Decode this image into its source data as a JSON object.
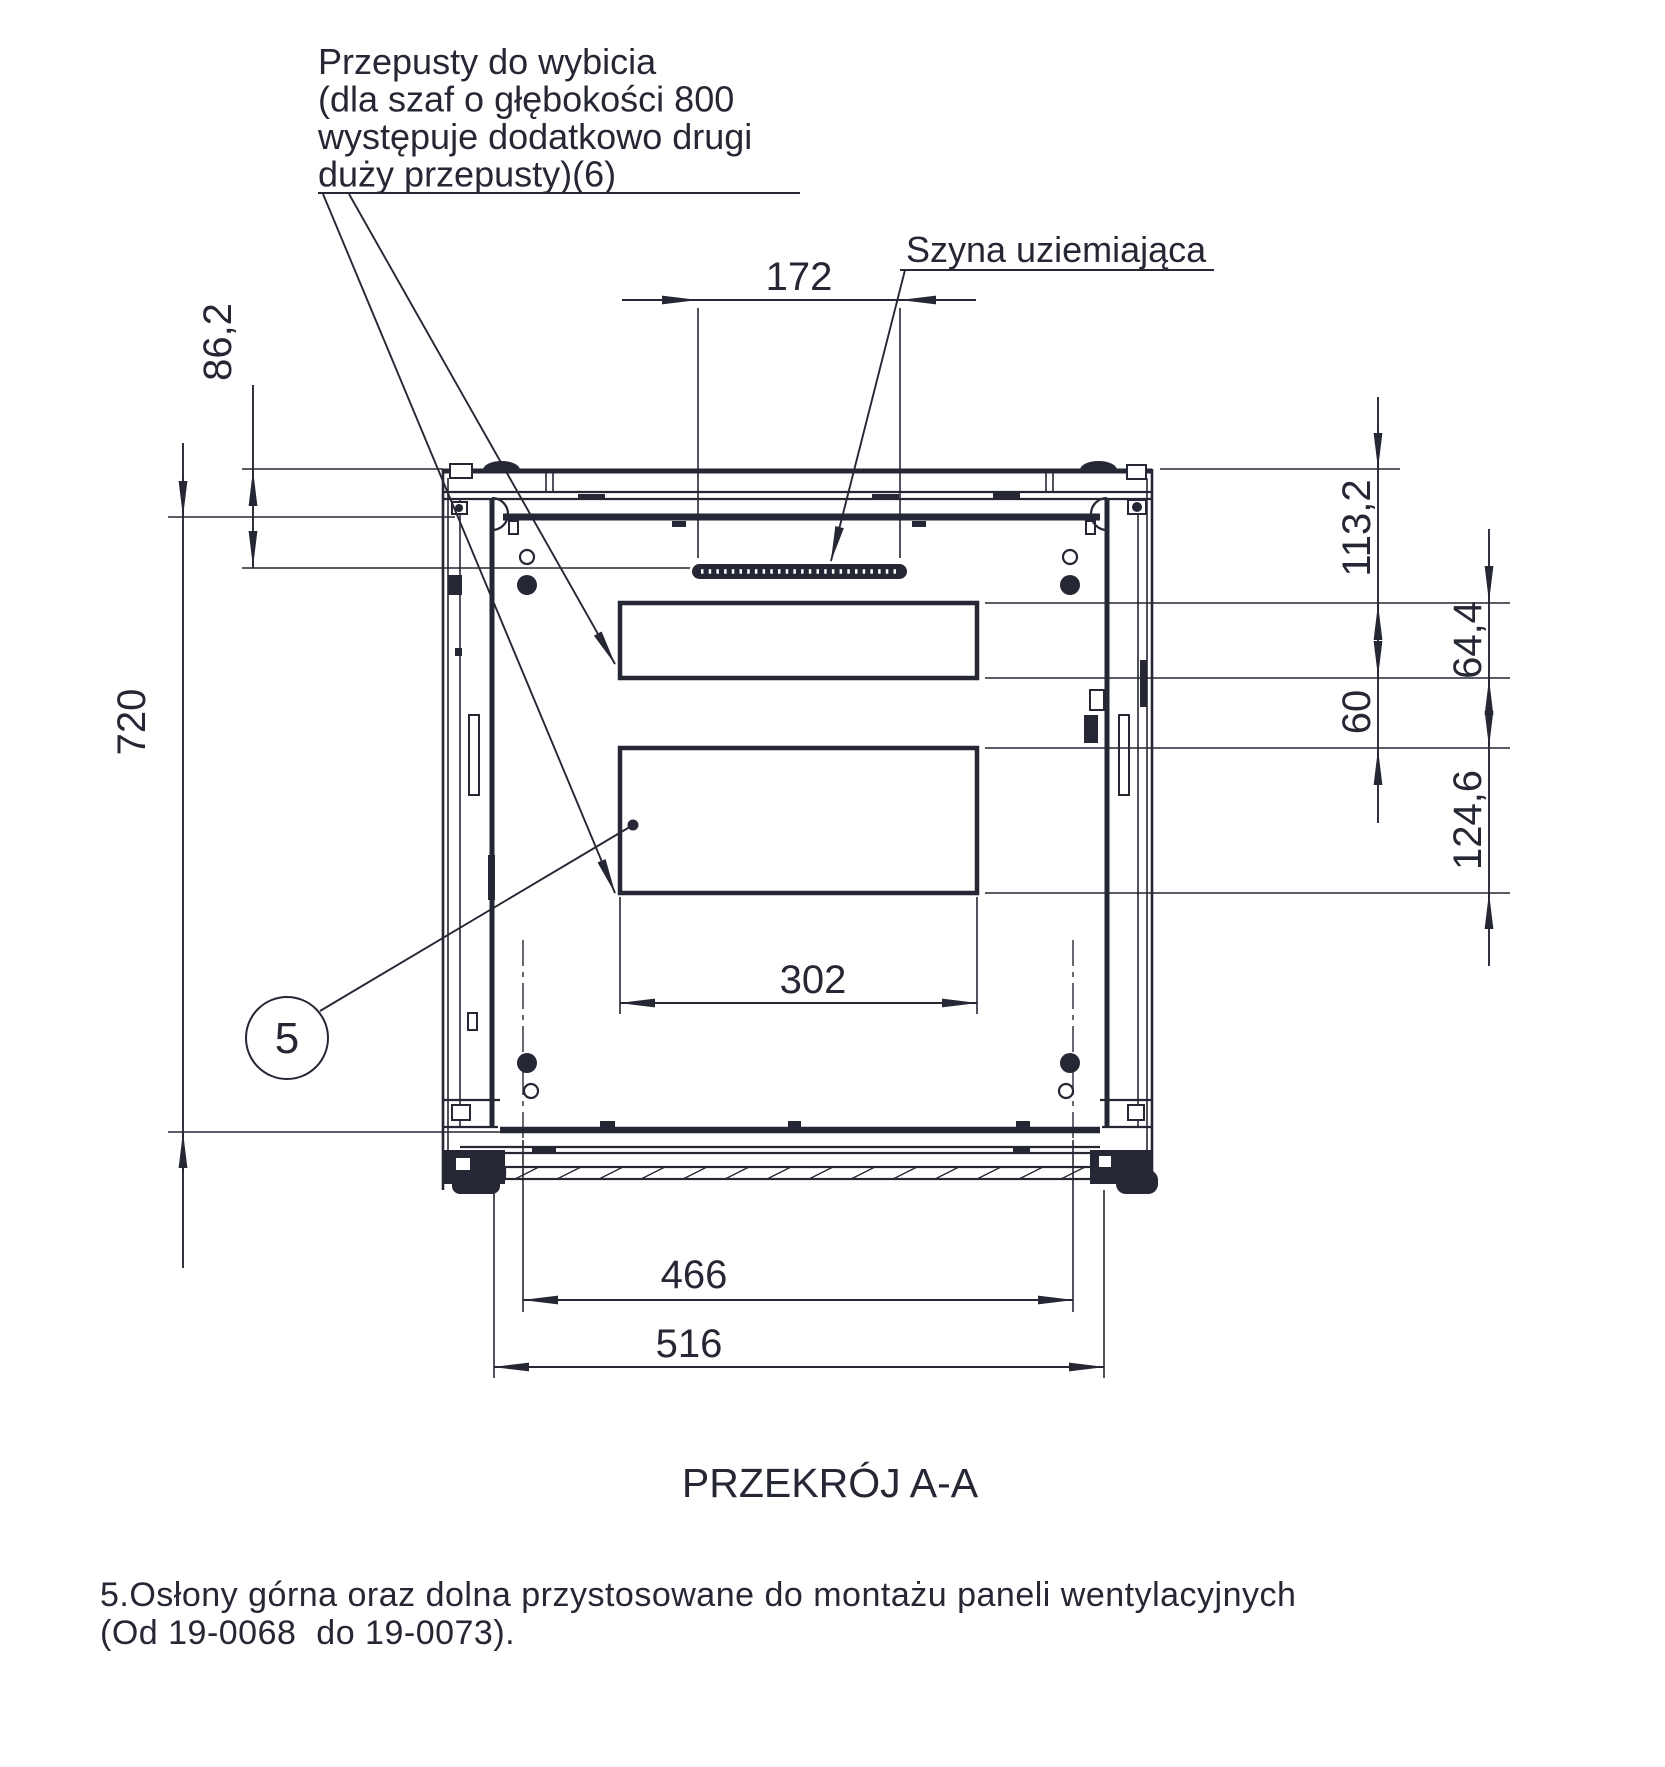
{
  "colors": {
    "line": "#262734",
    "background": "#ffffff"
  },
  "callout_knockouts": {
    "line1": "Przepusty do wybicia",
    "line2": "(dla szaf o głębokości 800",
    "line3": "występuje dodatkowo drugi",
    "line4": "duży przepusty)(6)"
  },
  "label_grounding_rail": "Szyna uziemiająca",
  "balloon": {
    "number": "5"
  },
  "dims": {
    "d172": "172",
    "d86_2": "86,2",
    "d720": "720",
    "d113_2": "113,2",
    "d64_4": "64,4",
    "d60": "60",
    "d124_6": "124,6",
    "d302": "302",
    "d466": "466",
    "d516": "516"
  },
  "section_title": "PRZEKRÓJ A-A",
  "note": {
    "line1": "5.Osłony górna oraz dolna przystosowane do montażu paneli wentylacyjnych",
    "line2": "(Od 19-0068  do 19-0073)."
  }
}
